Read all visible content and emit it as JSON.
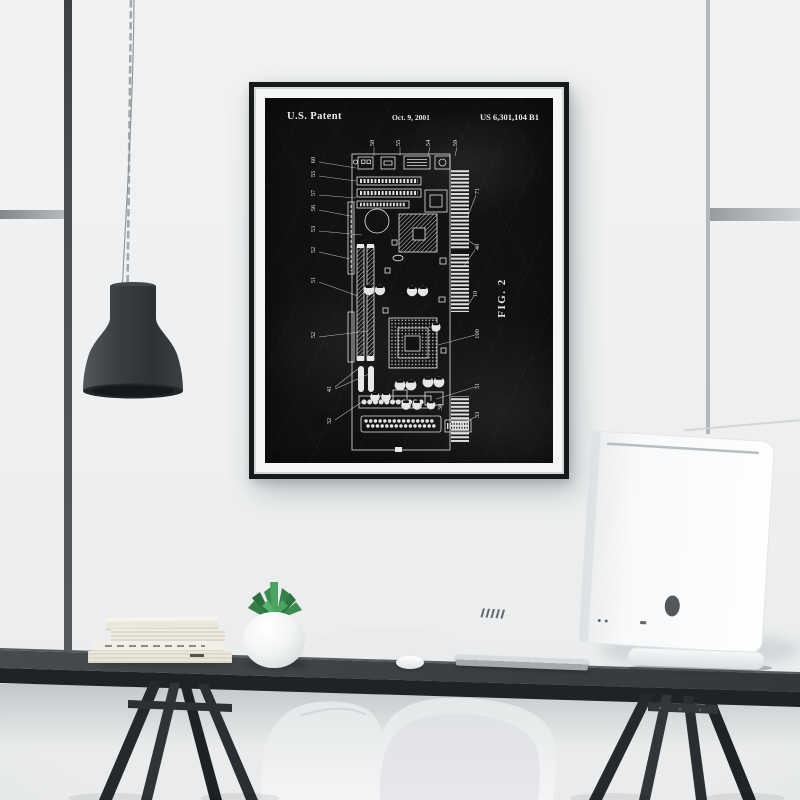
{
  "poster": {
    "title": "U.S. Patent",
    "date": "Oct. 9, 2001",
    "patent_number": "US 6,301,104 B1",
    "figure_label": "FIG. 2",
    "labels": {
      "top": [
        "58",
        "55",
        "54",
        "59"
      ],
      "left": [
        "60",
        "55",
        "57",
        "56",
        "53",
        "52",
        "51",
        "52",
        "41",
        "32"
      ],
      "right": [
        "71",
        "40",
        "10",
        "100",
        "31",
        "30",
        "33"
      ]
    },
    "colors": {
      "print_background": "#101214",
      "ink": "#e6e6e6",
      "mat": "#f5f6f6",
      "frame": "#17191b"
    }
  },
  "scene": {
    "wall_color": "#eef0f1",
    "desk_color": "#3c4145",
    "lamp_color": "#383c40",
    "objects": [
      "pendant-lamp",
      "window-frame-left",
      "window-frame-right",
      "patent-poster",
      "book-stack",
      "succulent-plant",
      "white-pebble",
      "keyboard",
      "desktop-computer",
      "shell-chair",
      "trestle-desk"
    ]
  }
}
